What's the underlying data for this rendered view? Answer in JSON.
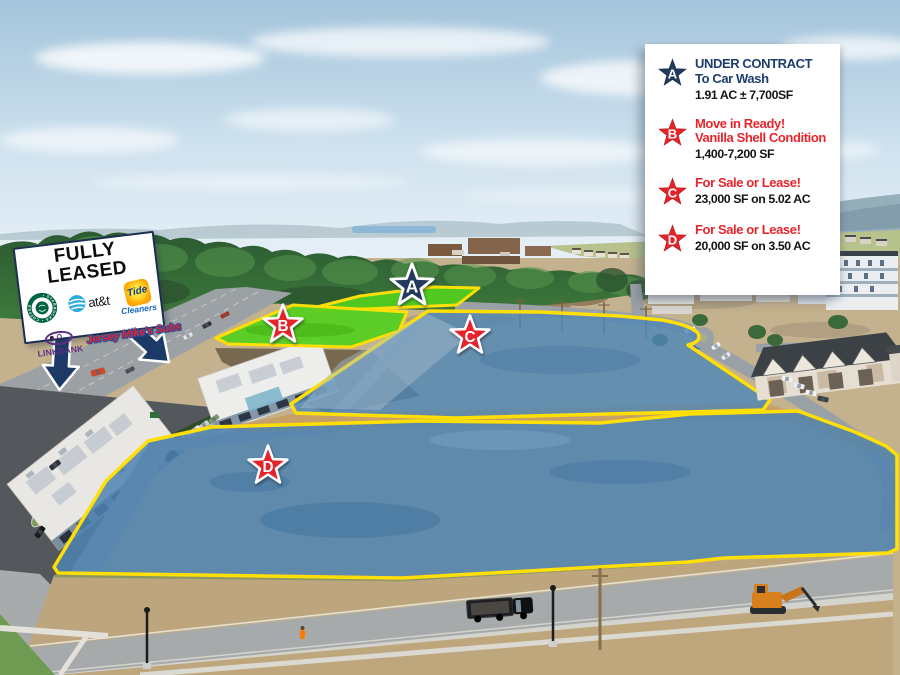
{
  "legend": {
    "items": [
      {
        "id": "A",
        "star_color": "#20395c",
        "line1": "UNDER CONTRACT",
        "line2": "To Car Wash",
        "detail": "1.91 AC ± 7,700SF",
        "text_color": "navy"
      },
      {
        "id": "B",
        "star_color": "#e62229",
        "line1": "Move in Ready!",
        "line2": "Vanilla Shell Condition",
        "detail": "1,400-7,200 SF",
        "text_color": "red"
      },
      {
        "id": "C",
        "star_color": "#e62229",
        "line1": "For Sale or Lease!",
        "detail": "23,000 SF on 5.02 AC",
        "text_color": "red"
      },
      {
        "id": "D",
        "star_color": "#e62229",
        "line1": "For Sale or Lease!",
        "detail": "20,000 SF on 3.50 AC",
        "text_color": "red"
      }
    ]
  },
  "sign": {
    "title": "FULLY LEASED",
    "tenants": {
      "starbucks_ring": "• STARBUCKS • COFFEE",
      "att": "at&t",
      "tide": "Tide",
      "tide_sub": "Cleaners",
      "linkbank": "LINKBANK",
      "jersey": "Jersey Mike's Subs"
    }
  },
  "map_markers": {
    "a": "A",
    "b": "B",
    "c": "C",
    "d": "D"
  },
  "colors": {
    "navy": "#1d3e6d",
    "red": "#e8252c",
    "parcel_blue": "#4d84b4",
    "parcel_green": "#53cf1d",
    "outline_yellow": "#ffdf05"
  }
}
